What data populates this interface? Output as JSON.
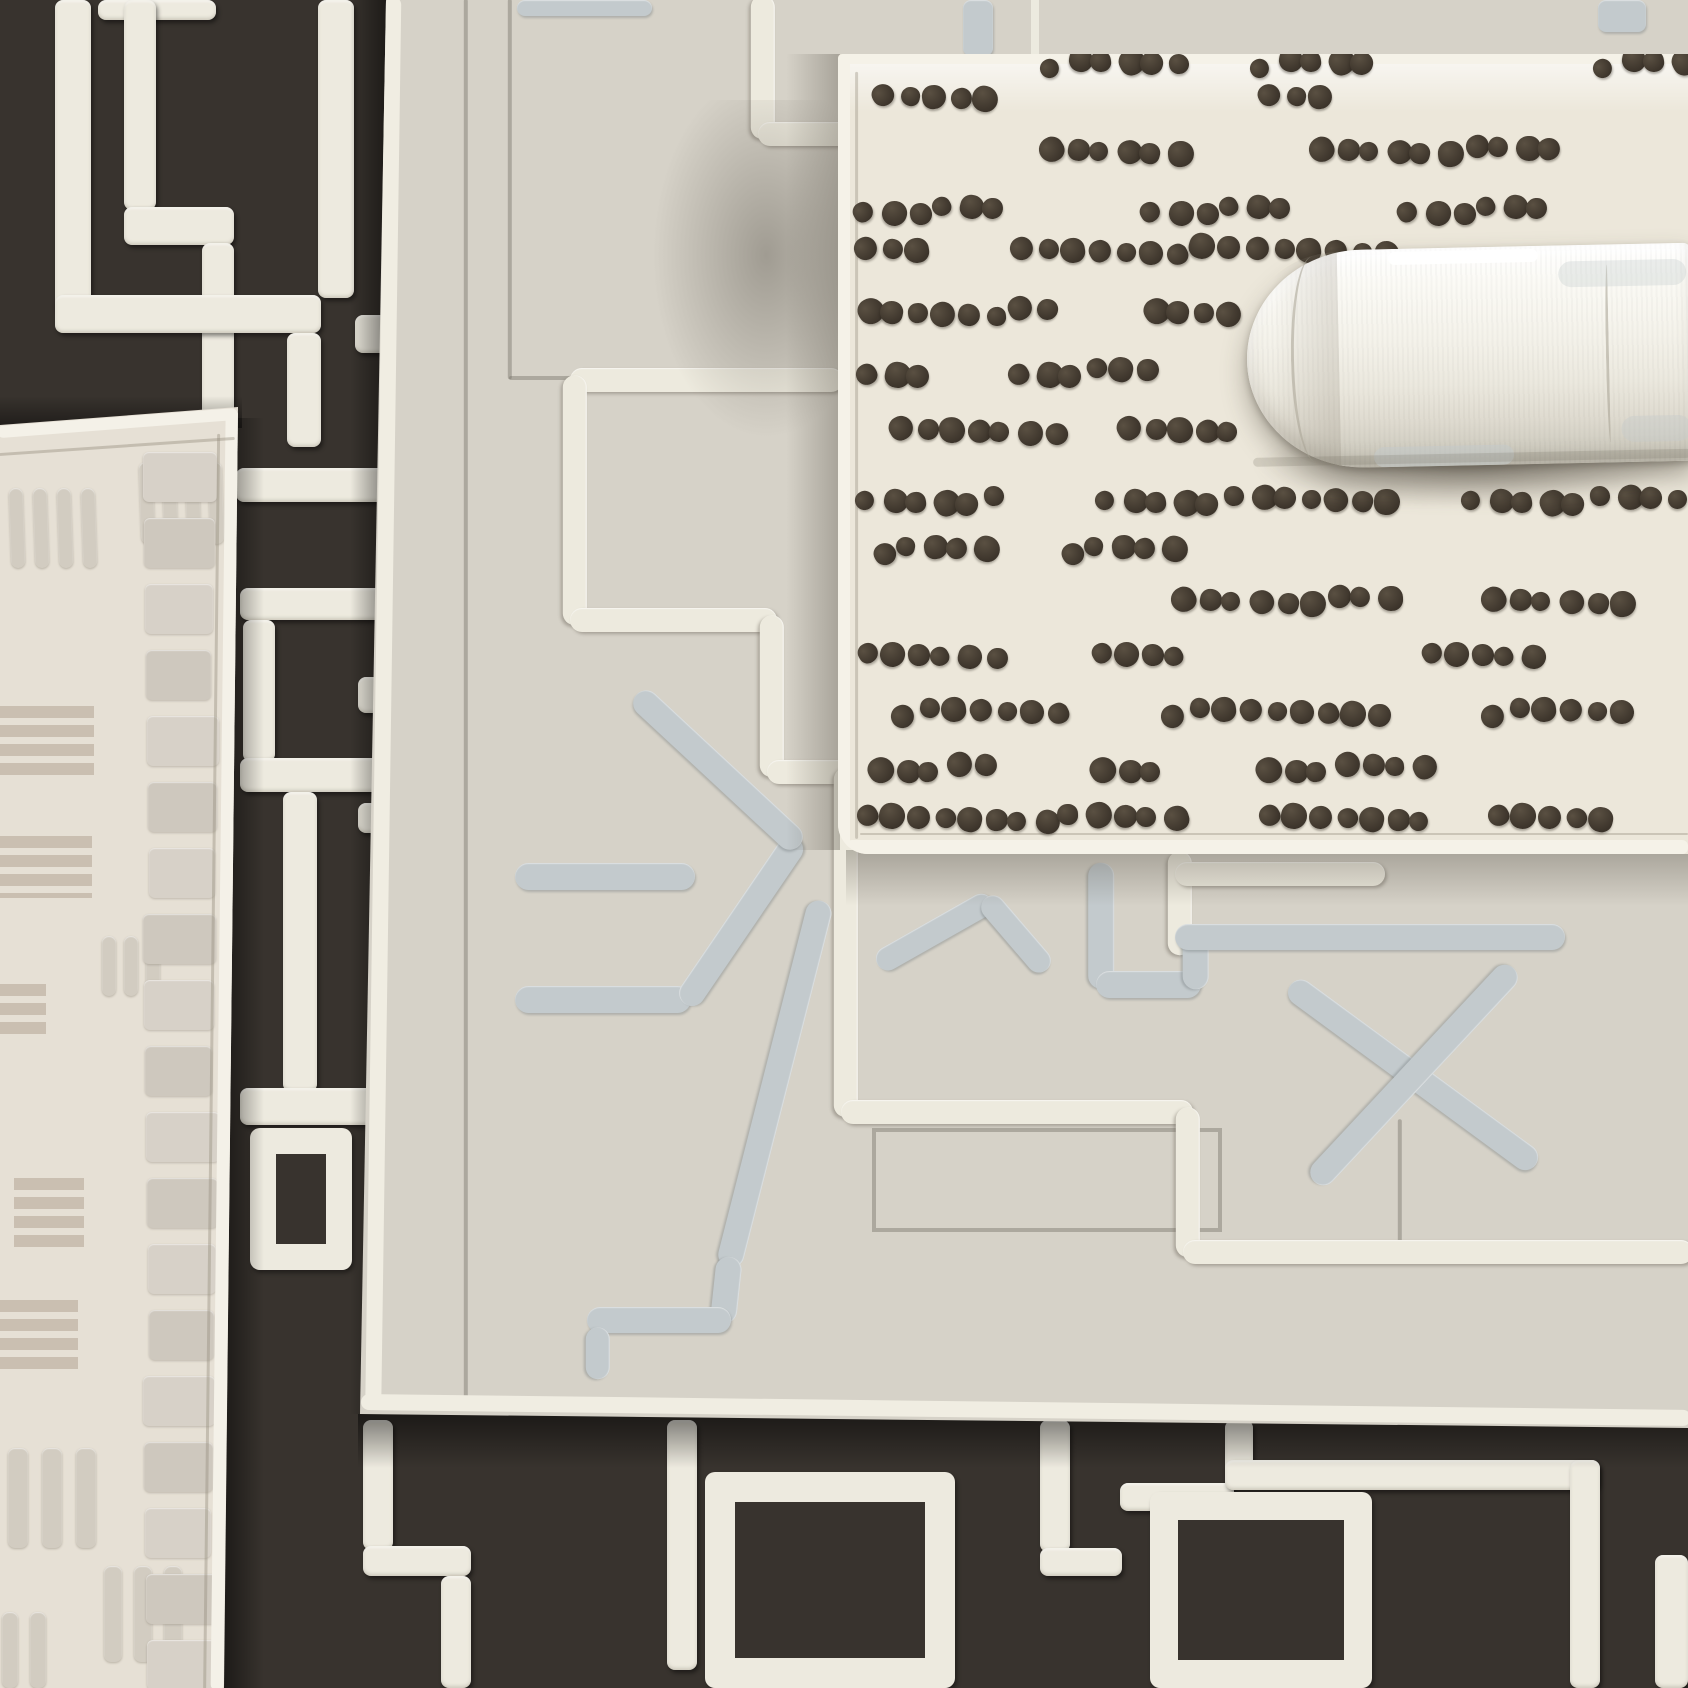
{
  "scene": {
    "width": 1688,
    "height": 1688,
    "description": "Overhead photograph of four layered geometric area rugs with a rolled white rug on top",
    "palette": {
      "dark_field": "#38332e",
      "white_pile": "#edeadf",
      "beige_field": "#e6e0d5",
      "taupe": "#c8bdaf",
      "beige_dash": "#d2ccc1",
      "gray_field": "#d6d2c8",
      "gray_binding": "#f0ede2",
      "motif_blue_gray": "#c3cacd",
      "cream_field": "#ece7da",
      "cream_binding": "#f5f2e8",
      "dot_brown": "#453c31",
      "roll_white": "#f7f5ef"
    }
  },
  "dark_rug": {
    "field": "#38332e",
    "line_color": "#edeadf",
    "bars": [
      [
        55,
        0,
        36,
        312
      ],
      [
        98,
        0,
        118,
        20
      ],
      [
        124,
        0,
        32,
        210
      ],
      [
        124,
        207,
        110,
        38
      ],
      [
        202,
        243,
        32,
        192
      ],
      [
        318,
        0,
        36,
        298
      ],
      [
        55,
        295,
        266,
        38
      ],
      [
        287,
        333,
        34,
        114
      ],
      [
        355,
        315,
        38,
        38
      ],
      [
        236,
        468,
        158,
        34
      ],
      [
        240,
        588,
        154,
        32
      ],
      [
        243,
        620,
        32,
        142
      ],
      [
        240,
        758,
        154,
        34
      ],
      [
        283,
        792,
        34,
        300
      ],
      [
        358,
        677,
        37,
        36
      ],
      [
        358,
        803,
        37,
        30
      ],
      [
        240,
        1088,
        154,
        37
      ],
      [
        363,
        1420,
        30,
        130
      ],
      [
        363,
        1546,
        108,
        30
      ],
      [
        441,
        1576,
        30,
        112
      ],
      [
        667,
        1420,
        30,
        250
      ],
      [
        1040,
        1420,
        30,
        132
      ],
      [
        1040,
        1548,
        82,
        28
      ],
      [
        1120,
        1483,
        114,
        28
      ],
      [
        1225,
        1420,
        28,
        62
      ],
      [
        1225,
        1460,
        374,
        30
      ],
      [
        1570,
        1460,
        30,
        228
      ],
      [
        1655,
        1555,
        33,
        133
      ]
    ],
    "outlines": [
      [
        250,
        1128,
        102,
        142,
        26
      ],
      [
        705,
        1472,
        250,
        216,
        30
      ],
      [
        1150,
        1492,
        222,
        196,
        28
      ]
    ],
    "shadows": [
      {
        "cls": "shade-l",
        "x": 350,
        "y": 0,
        "w": 40,
        "h": 1414
      },
      {
        "cls": "shade-rr",
        "x": 222,
        "y": 418,
        "w": 42,
        "h": 1270
      },
      {
        "cls": "shade-bb",
        "x": 358,
        "y": 1414,
        "w": 1330,
        "h": 54
      },
      {
        "cls": "shade-t",
        "x": 0,
        "y": 396,
        "w": 242,
        "h": 32
      }
    ]
  },
  "beige_rug": {
    "clip": "polygon(0px 425px, 238px 407px, 224px 1688px, 0px 1688px)",
    "field": "#e6e0d5",
    "binding": "#f4f1e8",
    "thin_color": "rgba(150,142,126,.5)",
    "binding_segs": [
      [
        0,
        432,
        236,
        414,
        12
      ],
      [
        232,
        412,
        217,
        1688,
        13
      ]
    ],
    "thin_segs": [
      [
        0,
        454,
        234,
        438,
        3
      ],
      [
        219,
        434,
        205,
        1688,
        3
      ]
    ],
    "taupe_color": "#c8bdaf",
    "taupe_blocks": [
      [
        0,
        706,
        94,
        70
      ],
      [
        0,
        836,
        92,
        62
      ],
      [
        0,
        984,
        46,
        56
      ],
      [
        14,
        1178,
        70,
        74
      ],
      [
        0,
        1300,
        78,
        74
      ]
    ],
    "dash_color": "#d2ccc1",
    "dash_groups": [
      {
        "x": 10,
        "y": 488,
        "n": 4,
        "dw": 14,
        "dh": 80,
        "gap": 10,
        "rot": -2
      },
      {
        "x": 140,
        "y": 462,
        "n": 4,
        "dw": 14,
        "dh": 82,
        "gap": 9,
        "rot": -2
      },
      {
        "x": 102,
        "y": 936,
        "n": 3,
        "dw": 14,
        "dh": 60,
        "gap": 8,
        "rot": 0
      },
      {
        "x": 8,
        "y": 1448,
        "n": 3,
        "dw": 20,
        "dh": 100,
        "gap": 14,
        "rot": 0
      },
      {
        "x": 104,
        "y": 1566,
        "n": 3,
        "dw": 18,
        "dh": 96,
        "gap": 12,
        "rot": 0
      },
      {
        "x": 2,
        "y": 1612,
        "n": 2,
        "dw": 16,
        "dh": 76,
        "gap": 12,
        "rot": 0
      }
    ],
    "ladder": {
      "x": 146,
      "y": 452,
      "w": 74,
      "bh": 50,
      "gap": 16,
      "n": 19,
      "colors": [
        "#d7d1c8",
        "#cec8be"
      ]
    }
  },
  "gray_rug": {
    "clip": "polygon(386px 0px, 1688px 0px, 1688px 1428px, 360px 1414px)",
    "field": "#d6d2c8",
    "binding": "#f0ede2",
    "binding_segs": [
      [
        393,
        0,
        373,
        1404,
        16
      ],
      [
        364,
        1402,
        1688,
        1418,
        16
      ]
    ],
    "white_color": "#edeade",
    "white_lines": [
      [
        763,
        0,
        763,
        134
      ],
      [
        763,
        134,
        850,
        134
      ],
      [
        575,
        380,
        838,
        380
      ],
      [
        575,
        380,
        575,
        620
      ],
      [
        575,
        620,
        772,
        620
      ],
      [
        772,
        620,
        772,
        772
      ],
      [
        772,
        772,
        846,
        772
      ],
      [
        846,
        772,
        846,
        1112
      ],
      [
        846,
        1112,
        1188,
        1112
      ],
      [
        1188,
        1112,
        1188,
        1252
      ],
      [
        1188,
        1252,
        1688,
        1252
      ],
      [
        1180,
        856,
        1180,
        950
      ],
      [
        1180,
        874,
        1380,
        874
      ]
    ],
    "thin_color": "rgba(118,112,102,.5)",
    "thin_lines": [
      [
        466,
        0,
        466,
        1406
      ],
      [
        510,
        0,
        510,
        378
      ],
      [
        510,
        378,
        575,
        378
      ],
      [
        1400,
        1120,
        1400,
        1248
      ]
    ],
    "braid": [
      1031,
      0,
      8,
      56
    ],
    "thin_outline": [
      872,
      1128,
      350,
      104,
      4
    ],
    "motif_color": "#c3cacd",
    "motif_segs": [
      [
        520,
        876,
        690,
        876,
        27
      ],
      [
        520,
        999,
        686,
        999,
        27
      ],
      [
        688,
        999,
        795,
        842,
        26
      ],
      [
        640,
        698,
        795,
        842,
        26
      ],
      [
        882,
        962,
        988,
        902,
        24
      ],
      [
        988,
        902,
        1043,
        966,
        24
      ],
      [
        1101,
        868,
        1101,
        984,
        26
      ],
      [
        1101,
        984,
        1196,
        984,
        27
      ],
      [
        1196,
        937,
        1196,
        984,
        26
      ],
      [
        1180,
        937,
        1560,
        937,
        26
      ],
      [
        1295,
        988,
        1532,
        1162,
        26
      ],
      [
        1510,
        972,
        1318,
        1178,
        26
      ],
      [
        1642,
        700,
        1688,
        748,
        24
      ],
      [
        820,
        906,
        729,
        1262,
        26
      ],
      [
        729,
        1262,
        723,
        1318,
        26
      ],
      [
        592,
        1320,
        726,
        1320,
        26
      ],
      [
        598,
        1332,
        598,
        1374,
        24
      ]
    ],
    "patches": [
      [
        517,
        0,
        135,
        16
      ],
      [
        963,
        0,
        30,
        56
      ],
      [
        1598,
        0,
        48,
        32
      ]
    ],
    "shadows": [
      {
        "cls": "shadow-blob",
        "x": 648,
        "y": 100,
        "w": 215,
        "h": 345
      },
      {
        "cls": "shade-r",
        "x": 786,
        "y": 54,
        "w": 54,
        "h": 796
      },
      {
        "cls": "shade-b",
        "x": 846,
        "y": 850,
        "w": 842,
        "h": 56
      }
    ]
  },
  "cream_rug": {
    "clip": "inset(54px 0px 834px 838px round 4px 0px 0px 30px)",
    "field": "#ece7da",
    "binding": "#f5f2e8",
    "binding_bars": [
      [
        838,
        54,
        850,
        10
      ],
      [
        838,
        54,
        12,
        800
      ],
      [
        846,
        840,
        842,
        14
      ]
    ],
    "thin_color": "rgba(150,142,128,.45)",
    "thin_segs": [
      [
        857,
        72,
        857,
        838,
        3
      ],
      [
        860,
        834,
        1688,
        834,
        2
      ]
    ],
    "curl": [
      838,
      64,
      850,
      48
    ],
    "dots": {
      "color": "#453c31",
      "gap": 25.5,
      "size": 23
    },
    "rows": [
      {
        "y": 64,
        "segs": [
          [
            1040,
            1195
          ],
          [
            1250,
            1365
          ],
          [
            1593,
            1688
          ]
        ]
      },
      {
        "y": 99,
        "segs": [
          [
            872,
            994
          ],
          [
            1258,
            1345
          ]
        ]
      },
      {
        "y": 150,
        "segs": [
          [
            1040,
            1192
          ],
          [
            1310,
            1555
          ]
        ]
      },
      {
        "y": 210,
        "segs": [
          [
            856,
            1012
          ],
          [
            1143,
            1290
          ],
          [
            1400,
            1545
          ]
        ]
      },
      {
        "y": 250,
        "segs": [
          [
            856,
            940
          ],
          [
            1012,
            1238
          ],
          [
            1248,
            1398
          ]
        ]
      },
      {
        "y": 312,
        "segs": [
          [
            856,
            1066
          ],
          [
            1142,
            1240
          ]
        ]
      },
      {
        "y": 372,
        "segs": [
          [
            856,
            938
          ],
          [
            1008,
            1160
          ]
        ]
      },
      {
        "y": 430,
        "segs": [
          [
            890,
            1080
          ],
          [
            1118,
            1238
          ]
        ]
      },
      {
        "y": 500,
        "segs": [
          [
            856,
            1014
          ],
          [
            1096,
            1398
          ],
          [
            1462,
            1688
          ]
        ]
      },
      {
        "y": 550,
        "segs": [
          [
            872,
            990
          ],
          [
            1060,
            1180
          ]
        ]
      },
      {
        "y": 600,
        "segs": [
          [
            1173,
            1397
          ],
          [
            1483,
            1633
          ]
        ]
      },
      {
        "y": 655,
        "segs": [
          [
            856,
            1012
          ],
          [
            1090,
            1180
          ],
          [
            1420,
            1560
          ]
        ]
      },
      {
        "y": 712,
        "segs": [
          [
            893,
            1075
          ],
          [
            1163,
            1397
          ],
          [
            1483,
            1640
          ]
        ]
      },
      {
        "y": 768,
        "segs": [
          [
            870,
            1010
          ],
          [
            1092,
            1180
          ],
          [
            1258,
            1430
          ]
        ]
      },
      {
        "y": 818,
        "segs": [
          [
            856,
            1182
          ],
          [
            1258,
            1440
          ],
          [
            1487,
            1620
          ]
        ]
      }
    ]
  },
  "roll": {
    "x": 1247,
    "y": 252,
    "w": 446,
    "h": 218,
    "rot": -1.2,
    "shadow": [
      4,
      188,
      440,
      74
    ],
    "cap": [
      0,
      2,
      92,
      214
    ],
    "creases": [
      [
        44,
        6,
        44,
        206
      ],
      [
        359,
        20,
        3,
        178
      ]
    ],
    "marks": [
      {
        "x": 143,
        "y": 3,
        "w": 150,
        "h": 13,
        "c": "rgba(255,255,255,.9)"
      },
      {
        "x": 313,
        "y": 16,
        "w": 128,
        "h": 26,
        "c": "rgba(199,205,205,.35)"
      },
      {
        "x": 125,
        "y": 198,
        "w": 140,
        "h": 20,
        "c": "rgba(197,203,203,.55)"
      },
      {
        "x": 373,
        "y": 172,
        "w": 70,
        "h": 26,
        "c": "rgba(197,203,203,.4)"
      },
      {
        "x": 4,
        "y": 206,
        "w": 438,
        "h": 9,
        "c": "rgba(120,112,100,.22)"
      }
    ]
  }
}
